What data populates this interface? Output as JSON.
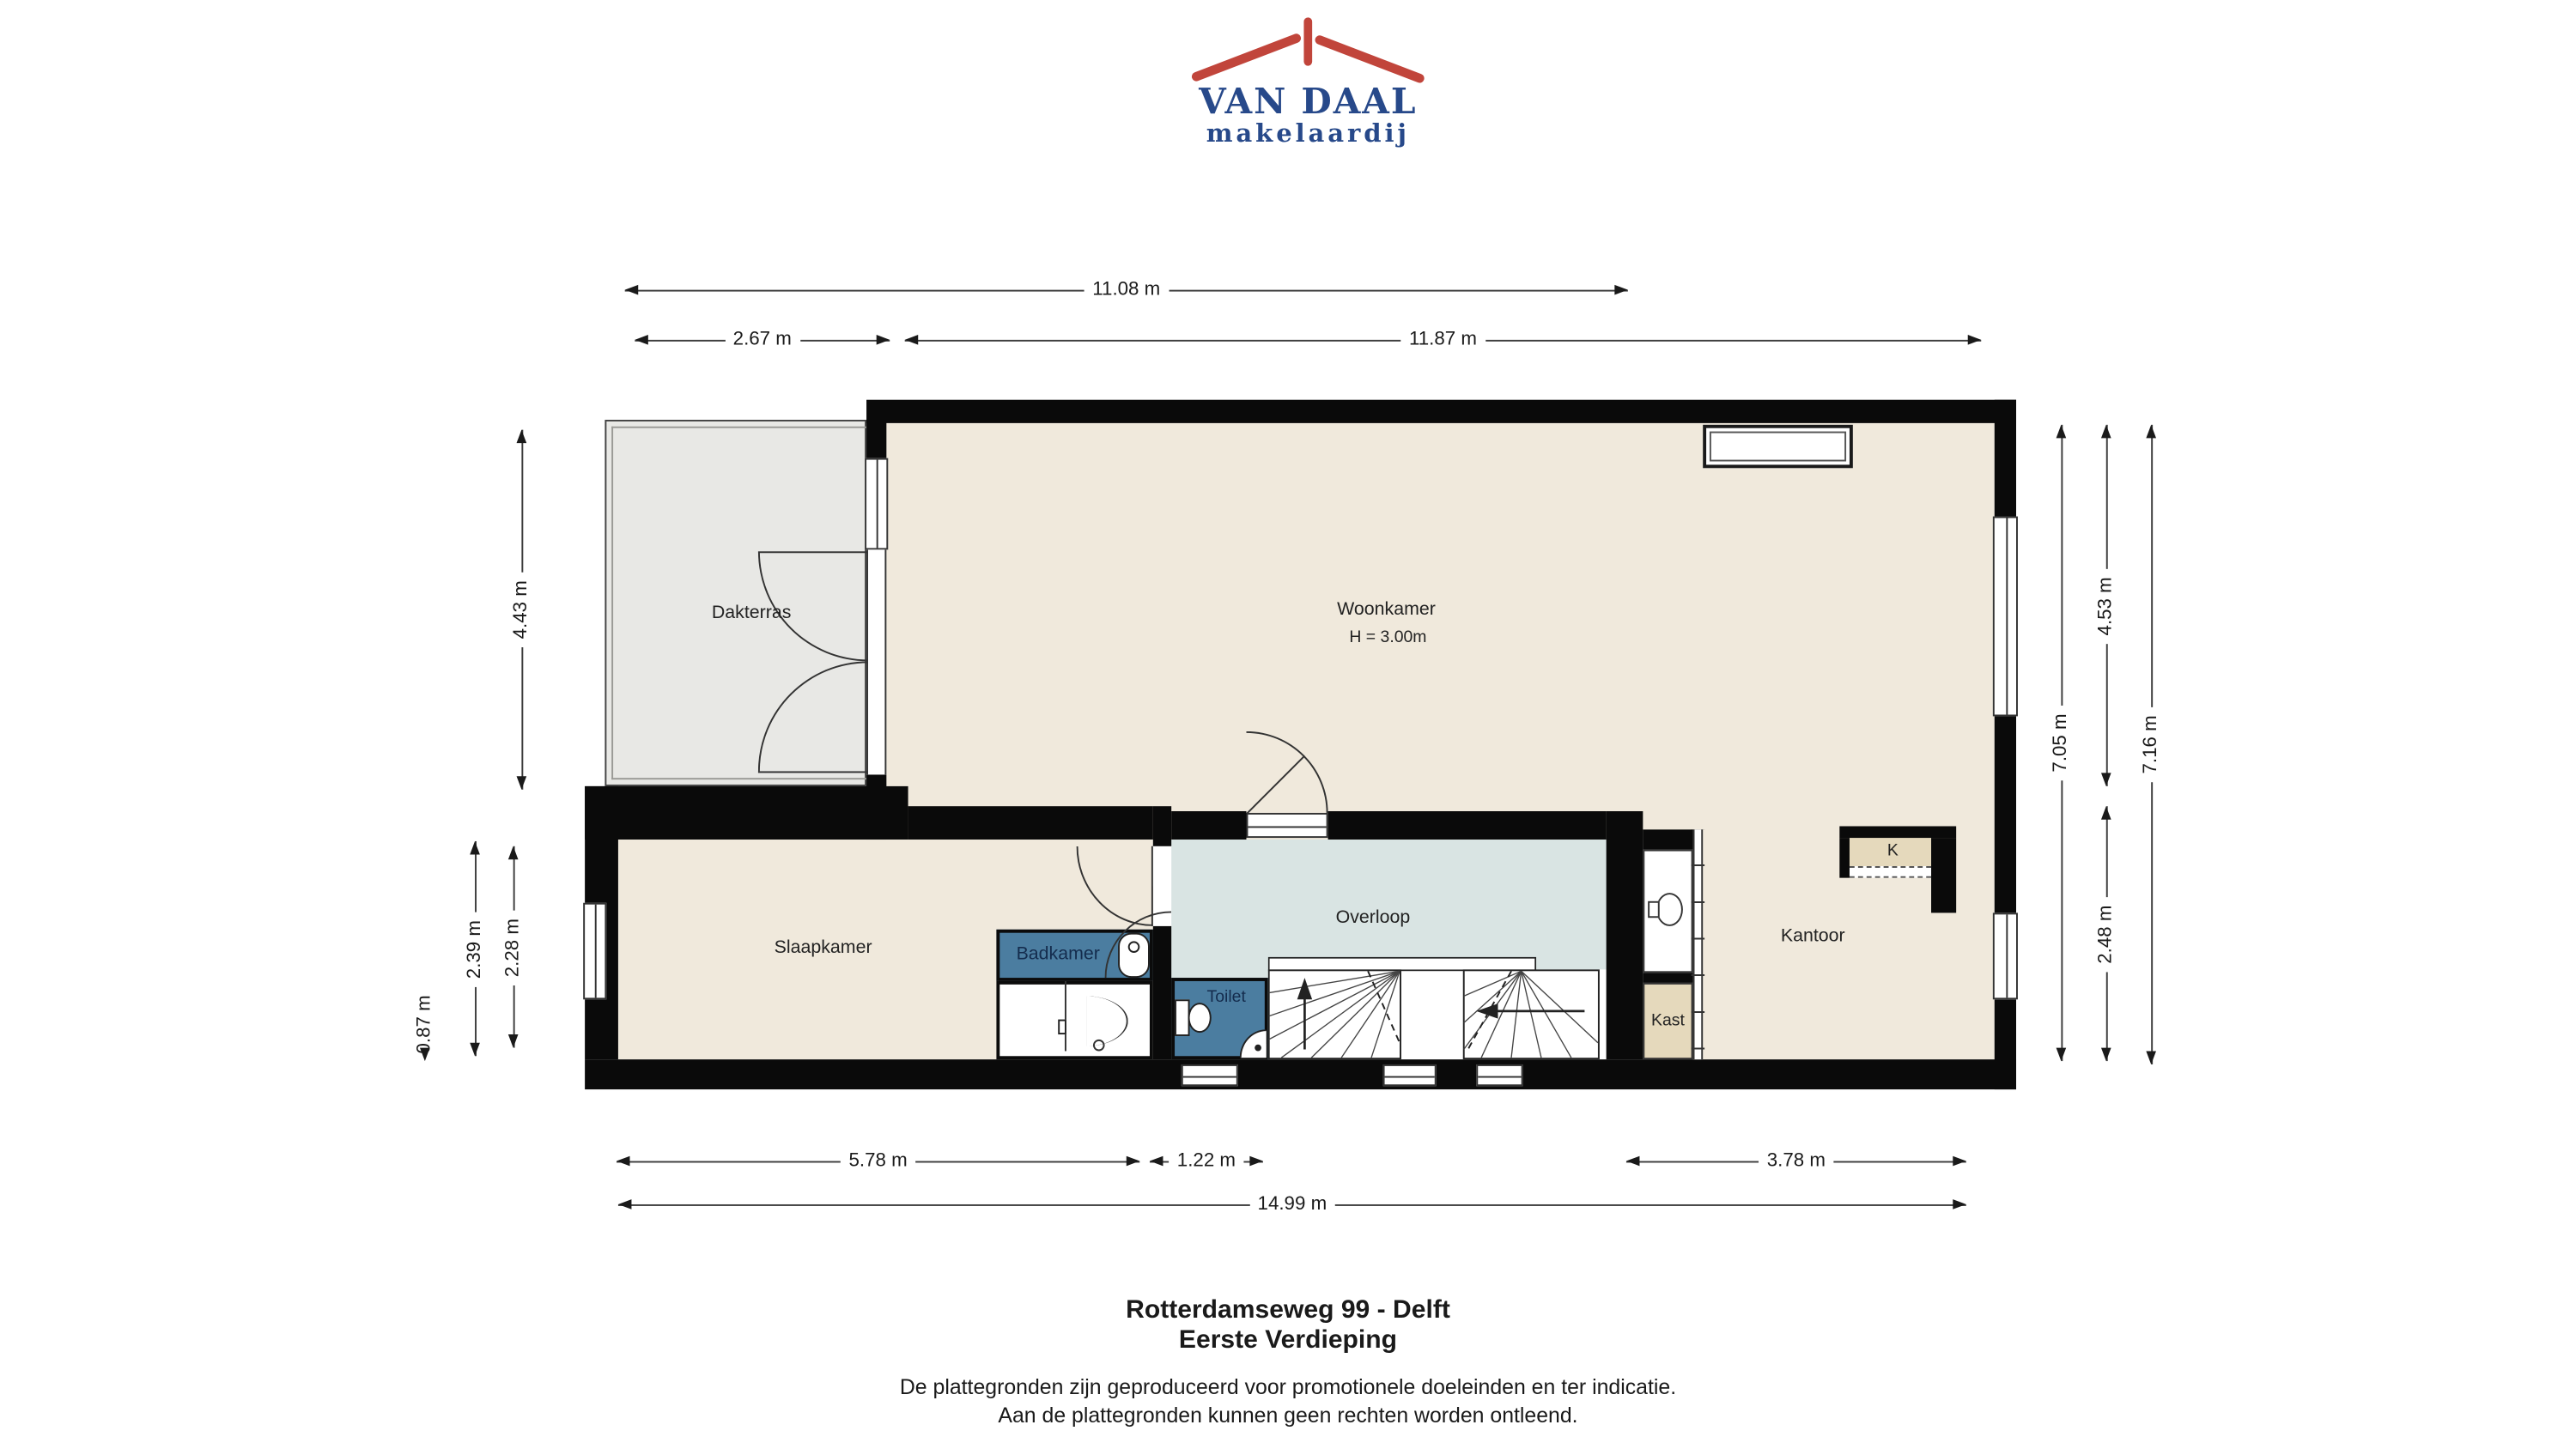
{
  "logo": {
    "title": "VAN DAAL",
    "subtitle": "makelaardij"
  },
  "rooms": {
    "dakterras": {
      "label": "Dakterras"
    },
    "woonkamer": {
      "label": "Woonkamer",
      "height_note": "H = 3.00m"
    },
    "slaapkamer": {
      "label": "Slaapkamer"
    },
    "badkamer": {
      "label": "Badkamer"
    },
    "toilet": {
      "label": "Toilet"
    },
    "overloop": {
      "label": "Overloop"
    },
    "kast": {
      "label": "Kast"
    },
    "kantoor": {
      "label": "Kantoor"
    },
    "k_nook": {
      "label": "K"
    }
  },
  "dims": {
    "top_total": "11.08 m",
    "top_dakterras": "2.67 m",
    "top_woonkamer": "11.87 m",
    "left_dakterras": "4.43 m",
    "left_outer": "2.39 m",
    "left_inner": "2.28 m",
    "left_step": "0.87 m",
    "right_inner": "7.05 m",
    "right_woonkamer": "4.53 m",
    "right_kantoor": "2.48 m",
    "right_outer": "7.16 m",
    "bottom_slaapkamer": "5.78 m",
    "bottom_stairs": "1.22 m",
    "bottom_kantoor": "3.78 m",
    "bottom_total": "14.99 m"
  },
  "footer": {
    "address": "Rotterdamseweg 99 - Delft",
    "floor_name": "Eerste Verdieping",
    "disclaimer_line1": "De plattegronden zijn geproduceerd voor promotionele doeleinden en ter indicatie.",
    "disclaimer_line2": "Aan de plattegronden kunnen geen rechten worden ontleend."
  },
  "colors": {
    "logo_blue": "#27498a",
    "logo_red": "#c1453b",
    "floor_beige": "#f0e9dc",
    "terrace_gray": "#e8e8e5",
    "hall_blue_gray": "#d9e4e3",
    "wet_room_blue": "#4b7da0",
    "closet_tan": "#e5d9bc",
    "wall_black": "#0a0a0a"
  }
}
